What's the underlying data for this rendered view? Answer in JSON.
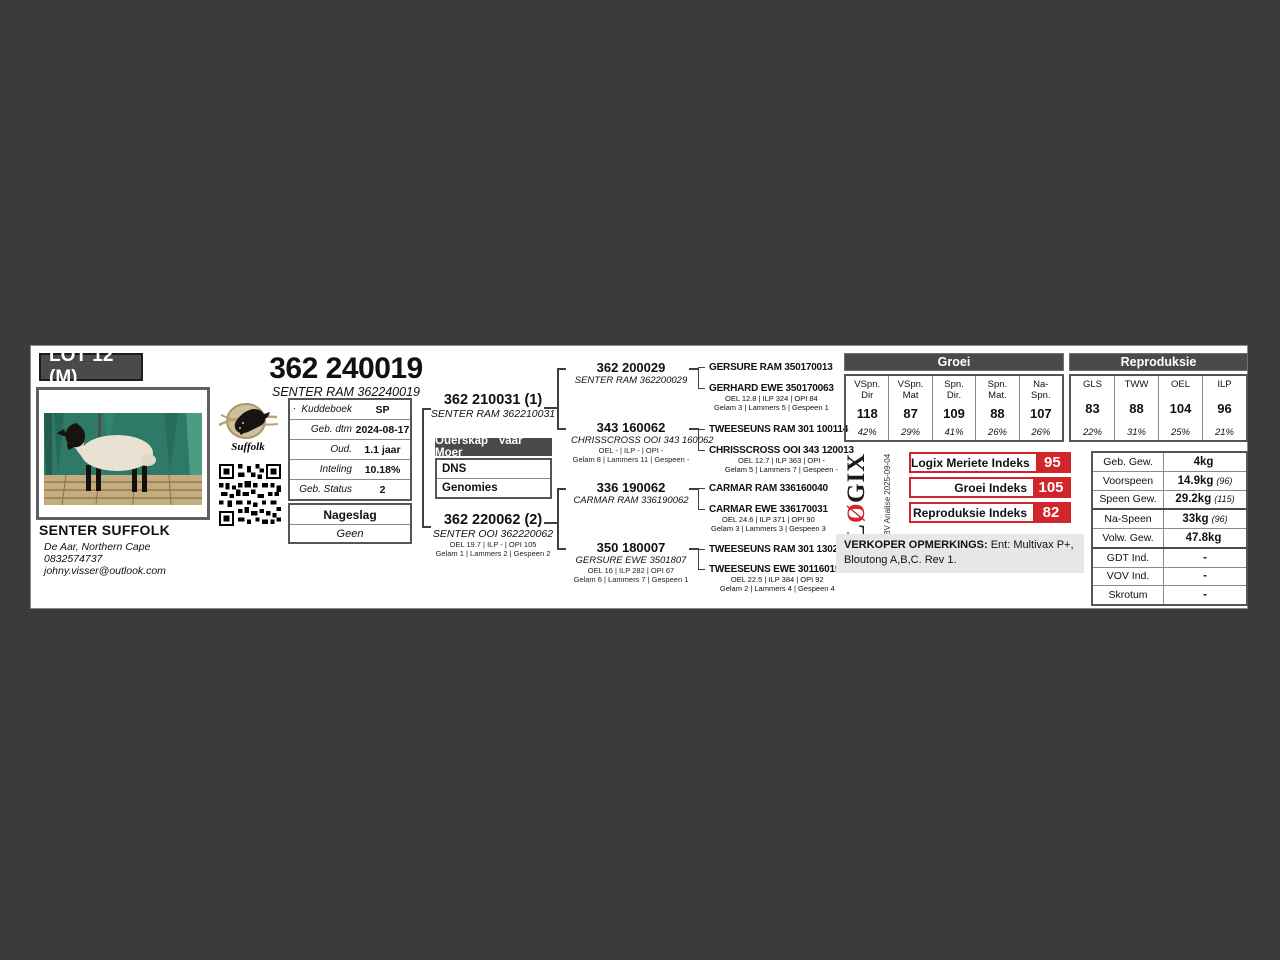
{
  "lot": {
    "label": "LOT 12 (M)"
  },
  "animal": {
    "title": "362 240019",
    "subtitle": "SENTER RAM 362240019"
  },
  "breeder": {
    "name": "SENTER SUFFOLK",
    "location": "De Aar, Northern Cape",
    "phone": "0832574737",
    "email": "johny.visser@outlook.com"
  },
  "logo": {
    "script": "Suffolk"
  },
  "info_table": {
    "bullet": ".",
    "rows": [
      {
        "label": "Kuddeboek",
        "value": "SP"
      },
      {
        "label": "Geb. dtm",
        "value": "2024-08-17"
      },
      {
        "label": "Oud.",
        "value": "1.1 jaar"
      },
      {
        "label": "Inteling",
        "value": "10.18%"
      },
      {
        "label": "Geb. Status",
        "value": "2"
      }
    ]
  },
  "nageslag": {
    "header": "Nageslag",
    "value": "Geen"
  },
  "pedigree": {
    "sire": {
      "title": "362 210031 (1)",
      "name": "SENTER RAM 362210031"
    },
    "dam": {
      "title": "362 220062 (2)",
      "name": "SENTER OOI 362220062",
      "stats1": "OEL 19.7 | ILP - | OPI 105",
      "stats2": "Gelam 1 | Lammers 2 | Gespeen 2"
    },
    "ouerskap": {
      "header": "Ouerskap Vaar Moer",
      "rows": [
        "DNS",
        "Genomies"
      ]
    },
    "grandparents": [
      {
        "title": "362 200029",
        "name": "SENTER RAM 362200029"
      },
      {
        "title": "343 160062",
        "name": "CHRISSCROSS OOI 343 160062",
        "stats1": "OEL - | ILP - | OPI -",
        "stats2": "Gelam 8 | Lammers 11 | Gespeen -"
      },
      {
        "title": "336 190062",
        "name": "CARMAR RAM 336190062"
      },
      {
        "title": "350 180007",
        "name": "GERSURE EWE 3501807",
        "stats1": "OEL 16 | ILP 282 | OPI 67",
        "stats2": "Gelam 6 | Lammers 7 | Gespeen 1"
      }
    ],
    "great_grandparents": [
      {
        "name": "GERSURE RAM 350170013"
      },
      {
        "name": "GERHARD EWE 350170063",
        "stats1": "OEL 12.8 | ILP 324 | OPI 84",
        "stats2": "Gelam 3 | Lammers 5 | Gespeen 1"
      },
      {
        "name": "TWEESEUNS RAM 301 100114"
      },
      {
        "name": "CHRISSCROSS OOI 343 120013",
        "stats1": "OEL 12.7 | ILP 363 | OPI -",
        "stats2": "Gelam 5 | Lammers 7 | Gespeen -"
      },
      {
        "name": "CARMAR RAM 336160040"
      },
      {
        "name": "CARMAR EWE 336170031",
        "stats1": "OEL 24.6 | ILP 371 | OPI 90",
        "stats2": "Gelam 3 | Lammers 3 | Gespeen 3"
      },
      {
        "name": "TWEESEUNS RAM 301 130206"
      },
      {
        "name": "TWEESEUNS EWE 301160152",
        "stats1": "OEL 22.5 | ILP 384 | OPI 92",
        "stats2": "Gelam 2 | Lammers 4 | Gespeen 4"
      }
    ]
  },
  "ebv": {
    "groei": {
      "header": "Groei",
      "cells": [
        {
          "label": "VSpn.\nDir",
          "value": "118",
          "acc": "42%"
        },
        {
          "label": "VSpn.\nMat",
          "value": "87",
          "acc": "29%"
        },
        {
          "label": "Spn.\nDir.",
          "value": "109",
          "acc": "41%"
        },
        {
          "label": "Spn.\nMat.",
          "value": "88",
          "acc": "26%"
        },
        {
          "label": "Na-\nSpn.",
          "value": "107",
          "acc": "26%"
        }
      ]
    },
    "repro": {
      "header": "Reproduksie",
      "cells": [
        {
          "label": "GLS",
          "value": "83",
          "acc": "22%"
        },
        {
          "label": "TWW",
          "value": "88",
          "acc": "31%"
        },
        {
          "label": "OEL",
          "value": "104",
          "acc": "25%"
        },
        {
          "label": "ILP",
          "value": "96",
          "acc": "21%"
        }
      ]
    }
  },
  "logix": {
    "brand_l": "L",
    "brand_o": "Ø",
    "brand_gix": "GIX",
    "analysis": "EBV Analise 2025-09-04",
    "indexes": [
      {
        "label": "Logix Meriete Indeks",
        "value": "95"
      },
      {
        "label": "Groei Indeks",
        "value": "105"
      },
      {
        "label": "Reproduksie Indeks",
        "value": "82"
      }
    ]
  },
  "remarks": {
    "label": "VERKOPER OPMERKINGS:",
    "text": " Ent: Multivax P+, Bloutong A,B,C. Rev 1."
  },
  "weights": {
    "rows": [
      {
        "label": "Geb. Gew.",
        "value": "4kg",
        "note": ""
      },
      {
        "label": "Voorspeen",
        "value": "14.9kg",
        "note": "(96)"
      },
      {
        "label": "Speen Gew.",
        "value": "29.2kg",
        "note": "(115)"
      },
      {
        "label": "Na-Speen",
        "value": "33kg",
        "note": "(96)"
      },
      {
        "label": "Volw. Gew.",
        "value": "47.8kg",
        "note": ""
      },
      {
        "label": "GDT Ind.",
        "value": "-",
        "note": ""
      },
      {
        "label": "VOV Ind.",
        "value": "-",
        "note": ""
      },
      {
        "label": "Skrotum",
        "value": "-",
        "note": ""
      }
    ]
  }
}
